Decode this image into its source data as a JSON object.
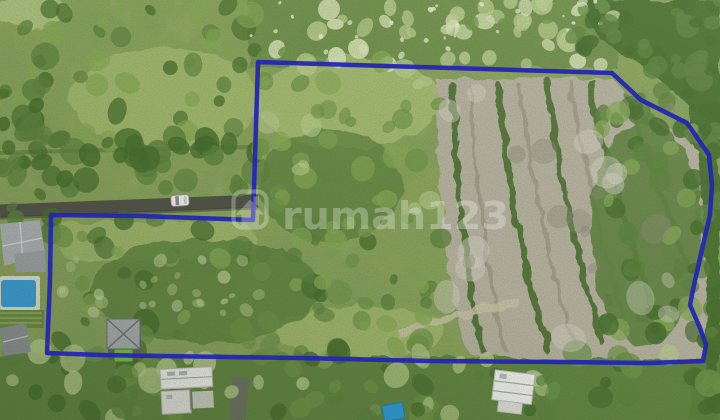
{
  "image": {
    "kind": "aerial-drone-photo",
    "subject": "land plot for sale with boundary overlay",
    "width": 720,
    "height": 420
  },
  "watermark": {
    "text": "rumah123",
    "icon": "house-in-rounded-square-icon",
    "color": "#FFFFFF",
    "opacity": 0.28
  },
  "boundary": {
    "color": "#2526B4",
    "stroke_width": 4.5,
    "opacity": 0.95,
    "points": "258,62 612,73 641,100 687,123 709,155 712,185 710,215 703,245 694,285 690,305 700,328 706,345 703,361 650,363 560,362 430,361 300,358 160,356 100,355 47,353 50,280 51,215 140,216 253,220"
  },
  "scene_objects": [
    "terraced-clearing",
    "forest",
    "meadow",
    "main-road",
    "white-car",
    "villa-with-pool",
    "garden-terraces",
    "house-with-green-pool",
    "construction-building",
    "construction-building-2",
    "blue-tarp",
    "driveway-road"
  ],
  "palette": {
    "base": "#8CA45D",
    "meadow": "#A8BE74",
    "leaf_light": "#86A855",
    "leaf_mid2": "#6F9449",
    "forest_mid": "#5E8340",
    "forest_dark": "#476E2E",
    "leaf_pale": "#B9CC8D",
    "canopy_pale": "#D8E3B6",
    "speckle_white": "#EBF0D6",
    "clearing_gray": "#B6B2A0",
    "clearing_shadow": "#94907C",
    "hedge_dark": "#55763A",
    "dirt_path": "#C9C3A6",
    "road_dark": "#53544A",
    "road_light": "#6E7165",
    "roof_gray": "#AFB3B7",
    "roof_gray2": "#8E9296",
    "wall_dark": "#62675A",
    "pool_blue": "#3BA0DA",
    "pool_green": "#77BC4E",
    "tarp_blue": "#2E9BD6",
    "car_white": "#F2F2EF"
  }
}
